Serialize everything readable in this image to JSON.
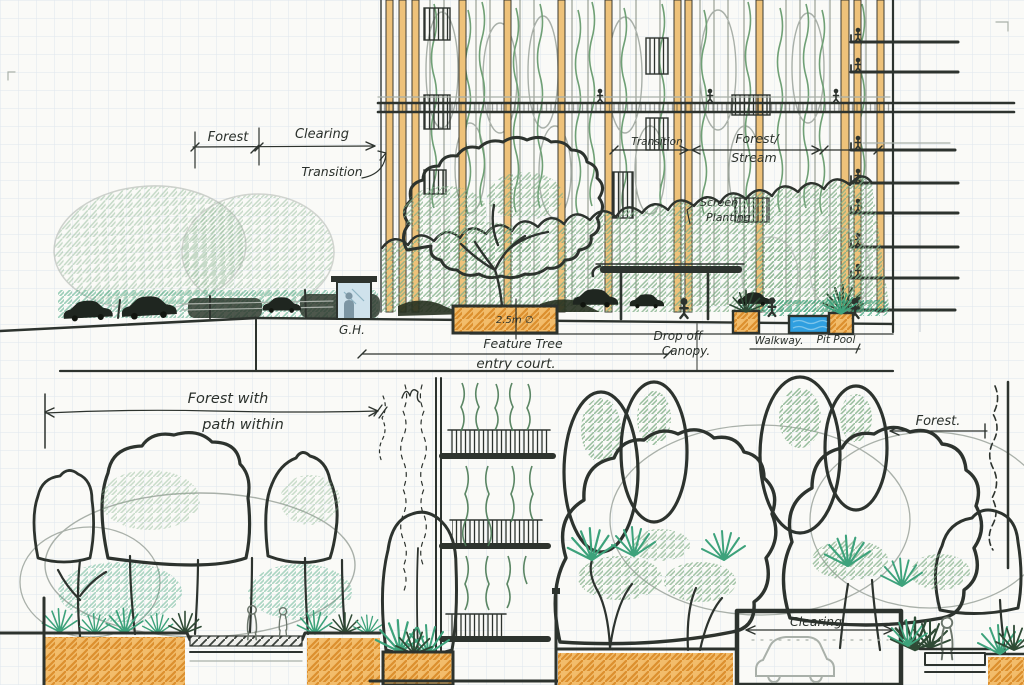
{
  "document": {
    "kind": "hand-drawn landscape architecture section sketches on gridded paper"
  },
  "colors": {
    "paper": "#fafaf7",
    "grid": "#dfe6ed",
    "ink": "#2d332e",
    "pencil_gray": "#a9b0a9",
    "foliage_green": "#7fae87",
    "understory_teal": "#3da27b",
    "structure_orange": "#eec27a",
    "soil_orange": "#f2bc6b",
    "water_blue": "#2f9fe0",
    "glass_blue": "#cfe2ec"
  },
  "labels": {
    "top": {
      "forest": "Forest",
      "clearing": "Clearing",
      "transition_left": "Transition",
      "transition_right": "Transition",
      "forest_stream1": "Forest/",
      "forest_stream2": "Stream",
      "screen1": "Screen",
      "screen2": "Planting",
      "gh": "G.H.",
      "planter_dim": "2.5m ∅",
      "feature_tree": "Feature Tree",
      "dropoff1": "Drop off",
      "dropoff2": "Canopy.",
      "walkway": "Walkway.",
      "pool": "Pit Pool",
      "entry_court": "entry court."
    },
    "bottom_left": {
      "dim1": "Forest with",
      "dim2": "path within"
    },
    "bottom_right": {
      "forest": "Forest.",
      "clearing": "Clearing."
    }
  }
}
